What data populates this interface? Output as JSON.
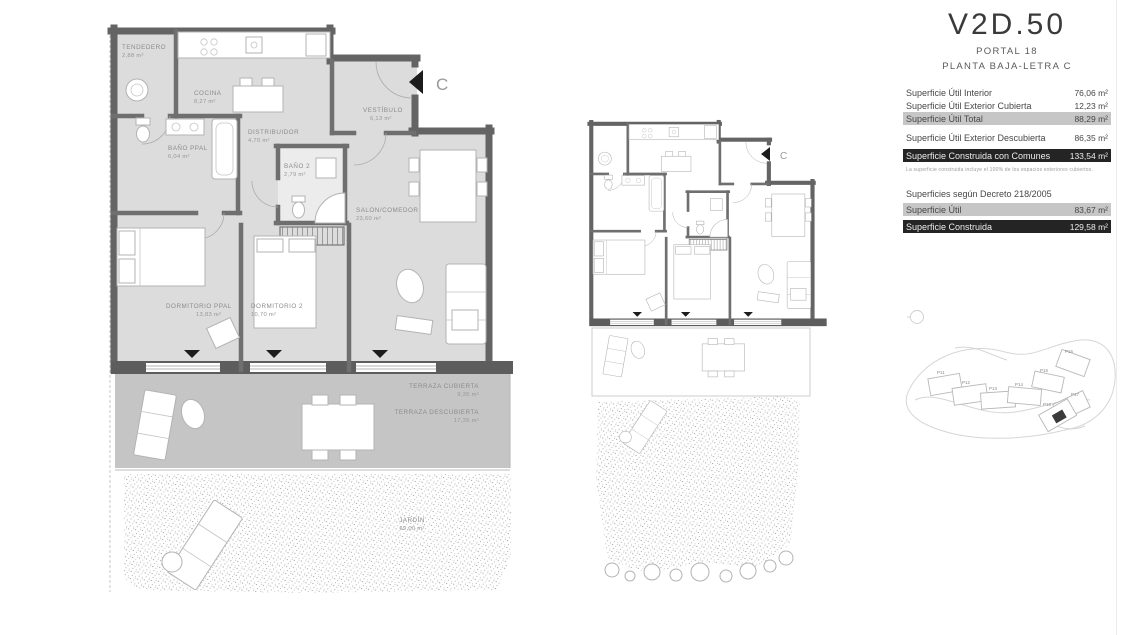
{
  "header": {
    "unit": "V2D.50",
    "portal": "PORTAL 18",
    "floor": "PLANTA BAJA-LETRA C"
  },
  "surface_table": {
    "rows": [
      {
        "label": "Superficie Útil Interior",
        "value": "76,06 m²"
      },
      {
        "label": "Superficie Útil Exterior Cubierta",
        "value": "12,23 m²"
      },
      {
        "label": "Superficie Útil Total",
        "value": "88,29 m²"
      },
      {
        "label": "Superficie Útil Exterior Descubierta",
        "value": "86,35 m²"
      },
      {
        "label": "Superficie Construida con Comunes",
        "value": "133,54 m²"
      }
    ],
    "note": "La superficie construida incluye el 100% de los espacios exteriores cubiertos.",
    "decree_title": "Superficies según Decreto 218/2005",
    "decree_rows": [
      {
        "label": "Superficie Útil",
        "value": "83,67 m²"
      },
      {
        "label": "Superficie Construida",
        "value": "129,58 m²"
      }
    ]
  },
  "floorplan": {
    "entry_label": "C",
    "rooms": [
      {
        "name": "TENDEDERO",
        "area": "2,88 m²"
      },
      {
        "name": "COCINA",
        "area": "8,27 m²"
      },
      {
        "name": "BAÑO PPAL",
        "area": "6,04 m²"
      },
      {
        "name": "DISTRIBUIDOR",
        "area": "4,70 m²"
      },
      {
        "name": "BAÑO 2",
        "area": "2,79 m²"
      },
      {
        "name": "VESTÍBULO",
        "area": "6,13 m²"
      },
      {
        "name": "SALON/COMEDOR",
        "area": "23,60 m²"
      },
      {
        "name": "DORMITORIO PPAL",
        "area": "13,83 m²"
      },
      {
        "name": "DORMITORIO 2",
        "area": "10,70 m²"
      },
      {
        "name": "TERRAZA CUBIERTA",
        "area": "9,35 m²"
      },
      {
        "name": "TERRAZA DESCUBIERTA",
        "area": "17,35 m²"
      },
      {
        "name": "JARDÍN",
        "area": "69,00 m²"
      }
    ]
  },
  "keyplan": {
    "entry_label": "C"
  },
  "siteplan": {
    "buildings": [
      "P11",
      "P12",
      "P13",
      "P14",
      "P15",
      "P16",
      "P17",
      "P18"
    ],
    "highlighted": "P18"
  },
  "colors": {
    "row_gray": "#c6c6c6",
    "row_dark": "#242424",
    "wall": "#646464",
    "room_fill": "#dcdcdc",
    "terrace_fill": "#c5c5c5"
  }
}
